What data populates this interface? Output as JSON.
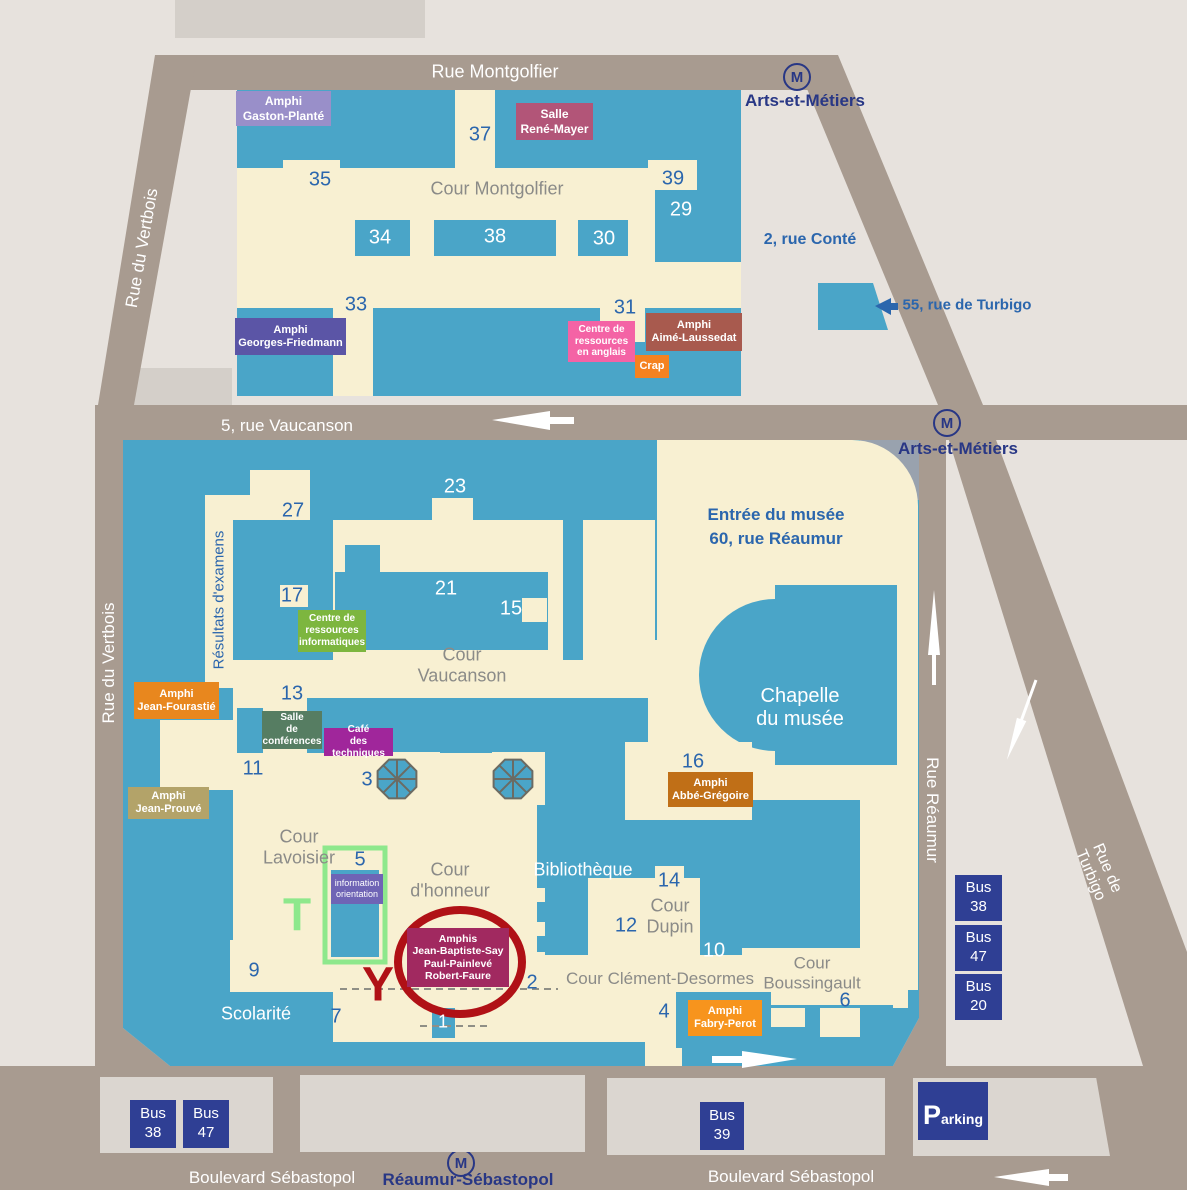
{
  "colors": {
    "building_blue": "#4aa5c8",
    "courtyard_cream": "#f8f0d2",
    "road_taupe": "#a89b90",
    "background": "#e7e2dd",
    "highlight_green": "#8ee88c",
    "circle_red": "#b01116",
    "cnam_blue": "#2b66ad",
    "metro_blue": "#283785",
    "bus_badge_blue": "#2f3f94"
  },
  "streets": {
    "rue_montgolfier": "Rue Montgolfier",
    "rue_du_vertbois_upper": "Rue du Vertbois",
    "rue_du_vertbois_lower": "Rue du Vertbois",
    "rue_vaucanson": "5, rue Vaucanson",
    "rue_reaumur": "Rue Réaumur",
    "rue_de_turbigo": "Rue de Turbigo",
    "boulevard_sebastopol_left": "Boulevard Sébastopol",
    "boulevard_sebastopol_right": "Boulevard Sébastopol"
  },
  "metro": {
    "symbol": "M",
    "station_top": "Arts-et-Métiers",
    "station_mid": "Arts-et-Métiers",
    "station_bottom": "Réaumur-Sébastopol"
  },
  "addresses": {
    "rue_conte": "2, rue Conté",
    "rue_turbigo_55": "55, rue de Turbigo",
    "musee_entrance": "Entrée du musée\n60, rue Réaumur",
    "rue_saint_martin": "292, rue Saint-Martin",
    "square_emile_chautemps": "Square Emile-Chautemps"
  },
  "courtyards": {
    "montgolfier": "Cour Montgolfier",
    "vaucanson": "Cour\nVaucanson",
    "lavoisier": "Cour\nLavoisier",
    "honneur": "Cour\nd'honneur",
    "dupin": "Cour\nDupin",
    "clement_desormes": "Cour Clément-Desormes",
    "boussingault": "Cour\nBoussingault"
  },
  "rooms": {
    "gaston_plante": "Amphi\nGaston-Planté",
    "rene_mayer": "Salle\nRené-Mayer",
    "georges_friedmann": "Amphi\nGeorges-Friedmann",
    "ressources_anglais": "Centre de\nressources\nen anglais",
    "crap": "Crap",
    "aime_laussedat": "Amphi\nAimé-Laussedat",
    "ressources_informatiques": "Centre de\nressources\ninformatiques",
    "salle_conferences": "Salle\nde\nconférences",
    "cafe_techniques": "Café\ndes techniques",
    "jean_fourastie": "Amphi\nJean-Fourastié",
    "jean_prouve": "Amphi\nJean-Prouvé",
    "abbe_gregoire": "Amphi\nAbbé-Grégoire",
    "information_orientation": "information\norientation",
    "amphis_say_painleve_faure": "Amphis\nJean-Baptiste-Say\nPaul-Painlevé\nRobert-Faure",
    "fabry_perot": "Amphi\nFabry-Perot"
  },
  "areas": {
    "chapelle": "Chapelle\ndu musée",
    "bibliotheque": "Bibliothèque",
    "scolarite": "Scolarité",
    "resultats_examens": "Résultats d'examens"
  },
  "numbers": {
    "n37": "37",
    "n35": "35",
    "n39": "39",
    "n29": "29",
    "n34": "34",
    "n38": "38",
    "n30": "30",
    "n33": "33",
    "n31": "31",
    "n23": "23",
    "n27": "27",
    "n21": "21",
    "n17": "17",
    "n15": "15",
    "n13": "13",
    "n11": "11",
    "n5": "5",
    "n3": "3",
    "n16": "16",
    "n14": "14",
    "n12": "12",
    "n10": "10",
    "n2": "2",
    "n9": "9",
    "n7": "7",
    "n1": "1",
    "n4": "4",
    "n6": "6"
  },
  "bus": {
    "right": [
      "Bus\n38",
      "Bus\n47",
      "Bus\n20"
    ],
    "bottom_left": [
      "Bus\n38",
      "Bus\n47"
    ],
    "bottom_middle": "Bus\n39"
  },
  "parking": "Parking",
  "markers": {
    "t": "T",
    "y": "Y"
  }
}
